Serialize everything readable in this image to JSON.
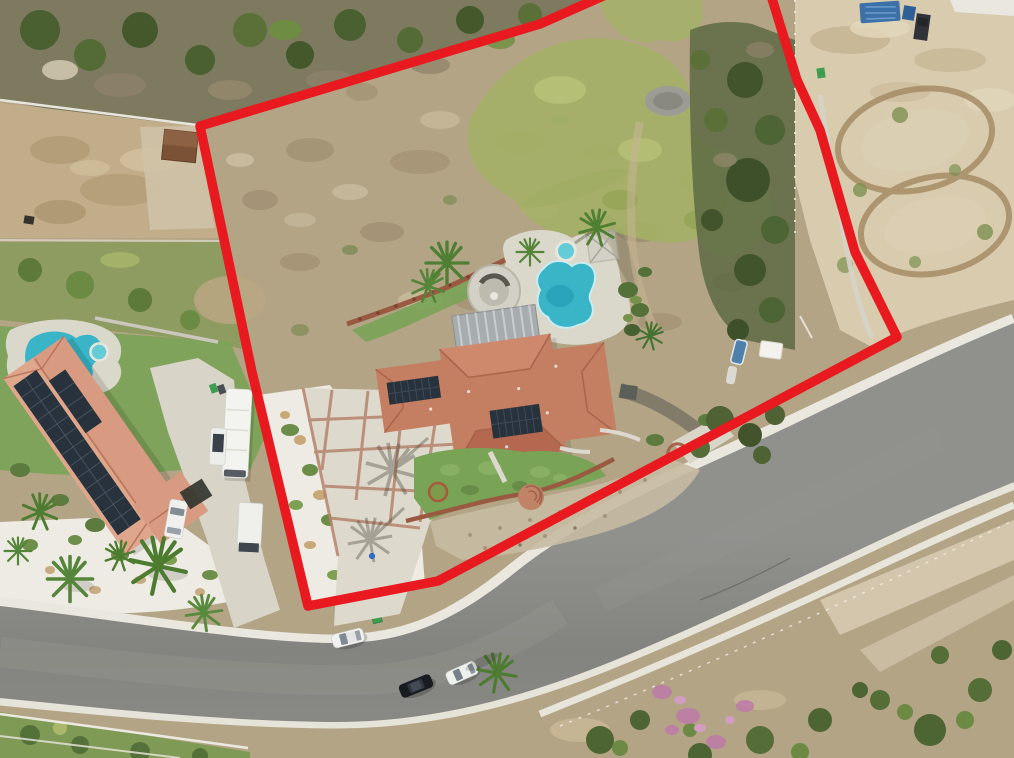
{
  "meta": {
    "type": "aerial-drone-photograph",
    "subject": "Overhead aerial view of a hillside residential parcel outlined with a red property-boundary overlay",
    "width_px": 1014,
    "height_px": 758
  },
  "annotation": {
    "boundary_color": "#e8191f",
    "boundary_points": "612,-8 540,24 200,126 252,372 308,606 438,581 897,337 855,252 820,130 797,80 770,-8",
    "style": "thick red polygon with rounded corners outlining the parcel"
  },
  "colors": {
    "terrain_dirt": "#b3a486",
    "brush_dark": "#4a6030",
    "groundcover": "#a3b264",
    "track_dirt": "#d8cbae",
    "track_line": "#a68c66",
    "road_asphalt": "#868683",
    "concrete_deck": "#dad7cb",
    "gravel_white": "#edebe3",
    "curb": "#e9e7de",
    "roof_tile_main": "#c47e62",
    "roof_tile_neighbor": "#d89a80",
    "solar_panel": "#28323c",
    "pool_water": "#3ab5c8",
    "spa_water": "#63ccd6",
    "lawn": "#79a355",
    "wall_brick": "#9a5a42",
    "flower_pink": "#bd7aa8"
  },
  "scene": {
    "main_parcel": [
      "large graded hillside lot of bare scrub outlined in red",
      "tile-roof house with rooftop solar panels",
      "kidney-shaped swimming pool with round spa",
      "circular paved patio with fire pit and slatted patio cover",
      "scored concrete driveway with brick grid",
      "white gravel yard with shrubs",
      "curved brick garden wall with semicircular steps",
      "small dog kennel near pool",
      "palm trees"
    ],
    "surroundings": [
      "neighboring estate with pool, solar roof, RV and parked vehicles (lower left)",
      "graded dirt pad with small shed (upper left)",
      "dirt riding track with two oval loops and blue-tarp shelter (upper right)",
      "curved asphalt street with parked cars crossing the lower half",
      "landscaped slope with pink flowering shrubs (lower right)"
    ],
    "vehicles_on_road": [
      {
        "type": "white car"
      },
      {
        "type": "black car"
      },
      {
        "type": "white car"
      }
    ]
  }
}
